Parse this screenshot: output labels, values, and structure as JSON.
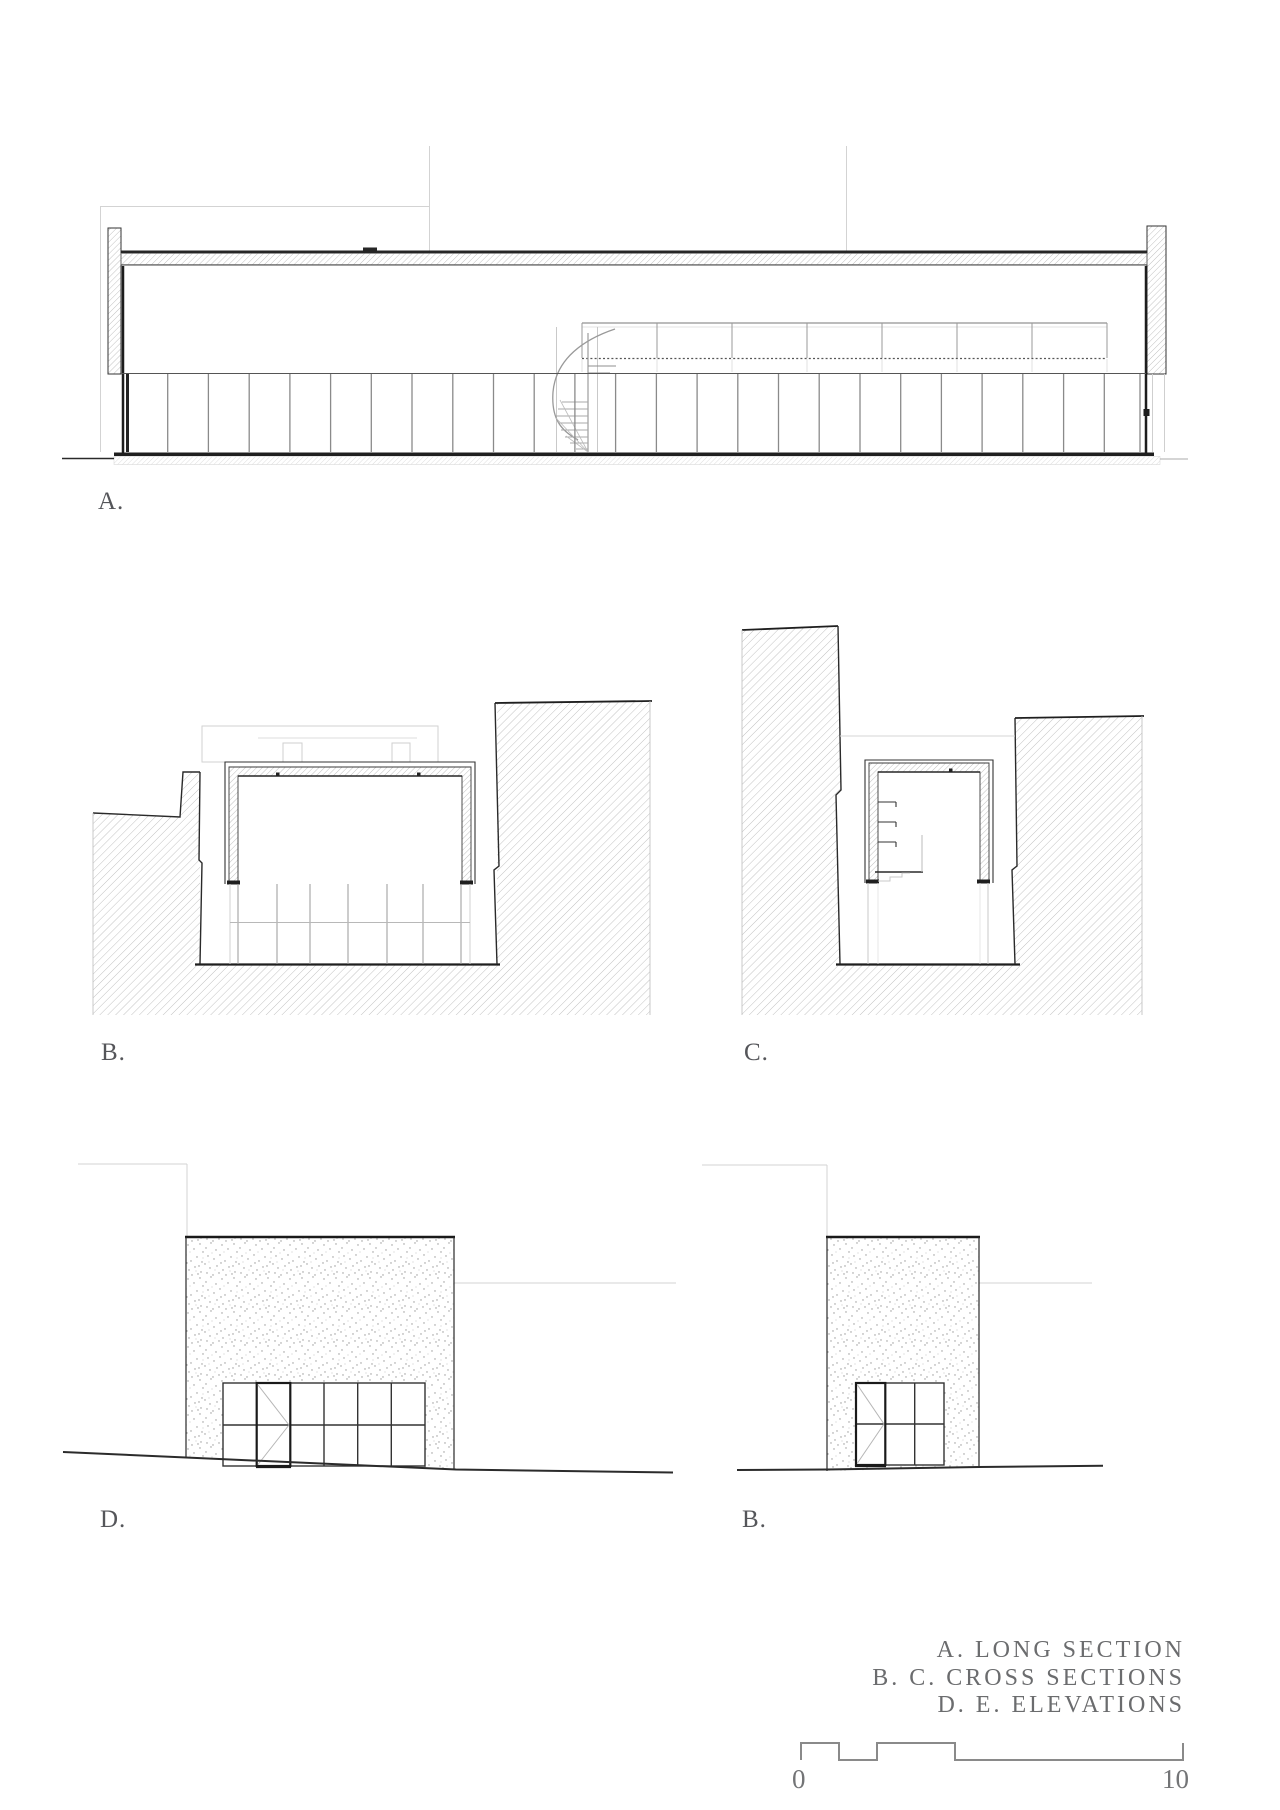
{
  "sheet": {
    "title_labels": {
      "section_a": "A.",
      "section_b": "B.",
      "section_c": "C.",
      "elevation_d": "D.",
      "elevation_e": "B."
    },
    "legend": {
      "lines": [
        "A. LONG SECTION",
        "B. C. CROSS SECTIONS",
        "D. E. ELEVATIONS"
      ]
    },
    "scale_bar": {
      "start_label": "0",
      "end_label": "10"
    },
    "colors": {
      "ink": "#2a2a2a",
      "mid_gray": "#8a8a8a",
      "light_gray": "#cfcfcf",
      "text_gray": "#6b6c6e"
    }
  }
}
